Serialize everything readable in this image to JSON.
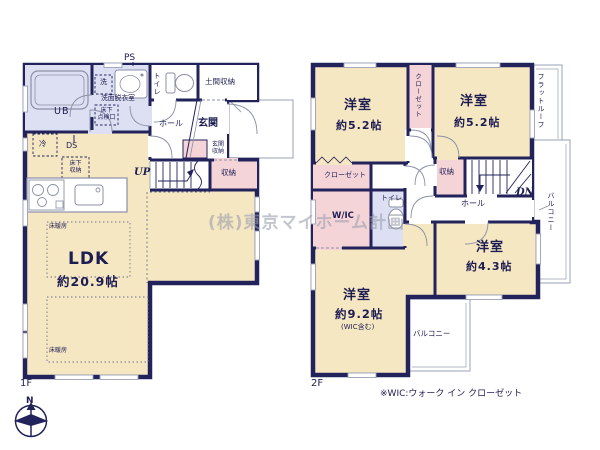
{
  "watermark": "(株)東京マイホーム計画",
  "footnote": "※WIC:ウォーク イン クローゼット",
  "compass": {
    "north": "N"
  },
  "colors": {
    "wall": "#23235c",
    "room_floor": "#f6e7c3",
    "closet_pink": "#f5d4d8",
    "wet_lavender": "#dce0f2",
    "text": "#1d1d52"
  },
  "floor1": {
    "label": "1F",
    "rooms": {
      "ldk": {
        "name": "LDK",
        "size": "約20.9帖"
      },
      "floor_heating_1": "床暖房",
      "floor_heating_2": "床暖房",
      "kitchen_fridge": "冷",
      "duct_space": "DS",
      "underfloor_storage": [
        "床下",
        "収納"
      ],
      "underfloor_access": [
        "床下",
        "点検口"
      ],
      "bath": "UB",
      "washroom": "洗面脱衣室",
      "washer": "洗",
      "pipe_space": "PS",
      "toilet": "トイレ",
      "entrance_storage_room": "土間収納",
      "hall": "ホール",
      "entrance": "玄関",
      "entrance_cabinet": [
        "玄関",
        "収納"
      ],
      "stairs_dir": "UP",
      "storage": "収納"
    }
  },
  "floor2": {
    "label": "2F",
    "rooms": {
      "bedroom_nw": {
        "name": "洋室",
        "size": "約5.2帖"
      },
      "bedroom_ne": {
        "name": "洋室",
        "size": "約5.2帖"
      },
      "bedroom_se": {
        "name": "洋室",
        "size": "約4.3帖"
      },
      "bedroom_sw": {
        "name": "洋室",
        "size": "約9.2帖",
        "note": "(WIC含む)"
      },
      "closet_strip": "クローゼット",
      "closet_room": "クローゼット",
      "wic": "W/IC",
      "toilet": "トイレ",
      "storage": "収納",
      "hall": "ホール",
      "stairs_dir": "DN",
      "flat_roof": "フラットルーフ",
      "balcony_east": "バルコニー",
      "balcony_south": "バルコニー"
    }
  }
}
